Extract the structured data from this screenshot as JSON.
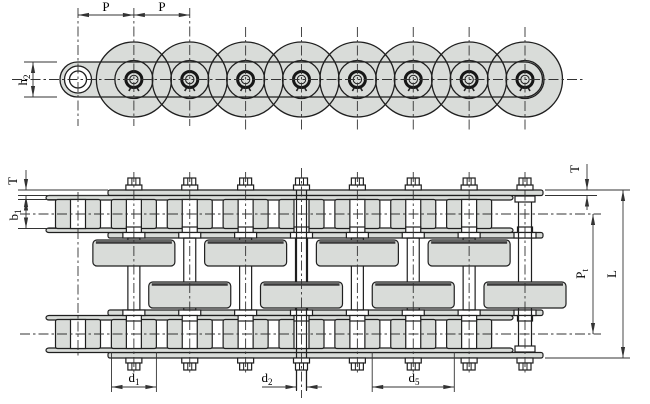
{
  "drawing": {
    "description": "Duplex roller chain engineering drawing, side elevation (top) and plan view (bottom) with dimension labels",
    "top_view": {
      "dim_p1": "P",
      "dim_p2": "P",
      "dim_h2": {
        "base": "h",
        "sub": "2"
      }
    },
    "bottom_view": {
      "dim_t_left": "T",
      "dim_b1": {
        "base": "b",
        "sub": "1"
      },
      "dim_d1": {
        "base": "d",
        "sub": "1"
      },
      "dim_d2": {
        "base": "d",
        "sub": "2"
      },
      "dim_d5": {
        "base": "d",
        "sub": "5"
      },
      "dim_t_right": "T",
      "dim_pt": {
        "base": "P",
        "sub": "t"
      },
      "dim_l": "L"
    },
    "colors": {
      "background": "#ffffff",
      "part_fill": "#d9dcd9",
      "outline": "#1f1f1f",
      "dim_line": "#333333",
      "text": "#000000"
    }
  }
}
